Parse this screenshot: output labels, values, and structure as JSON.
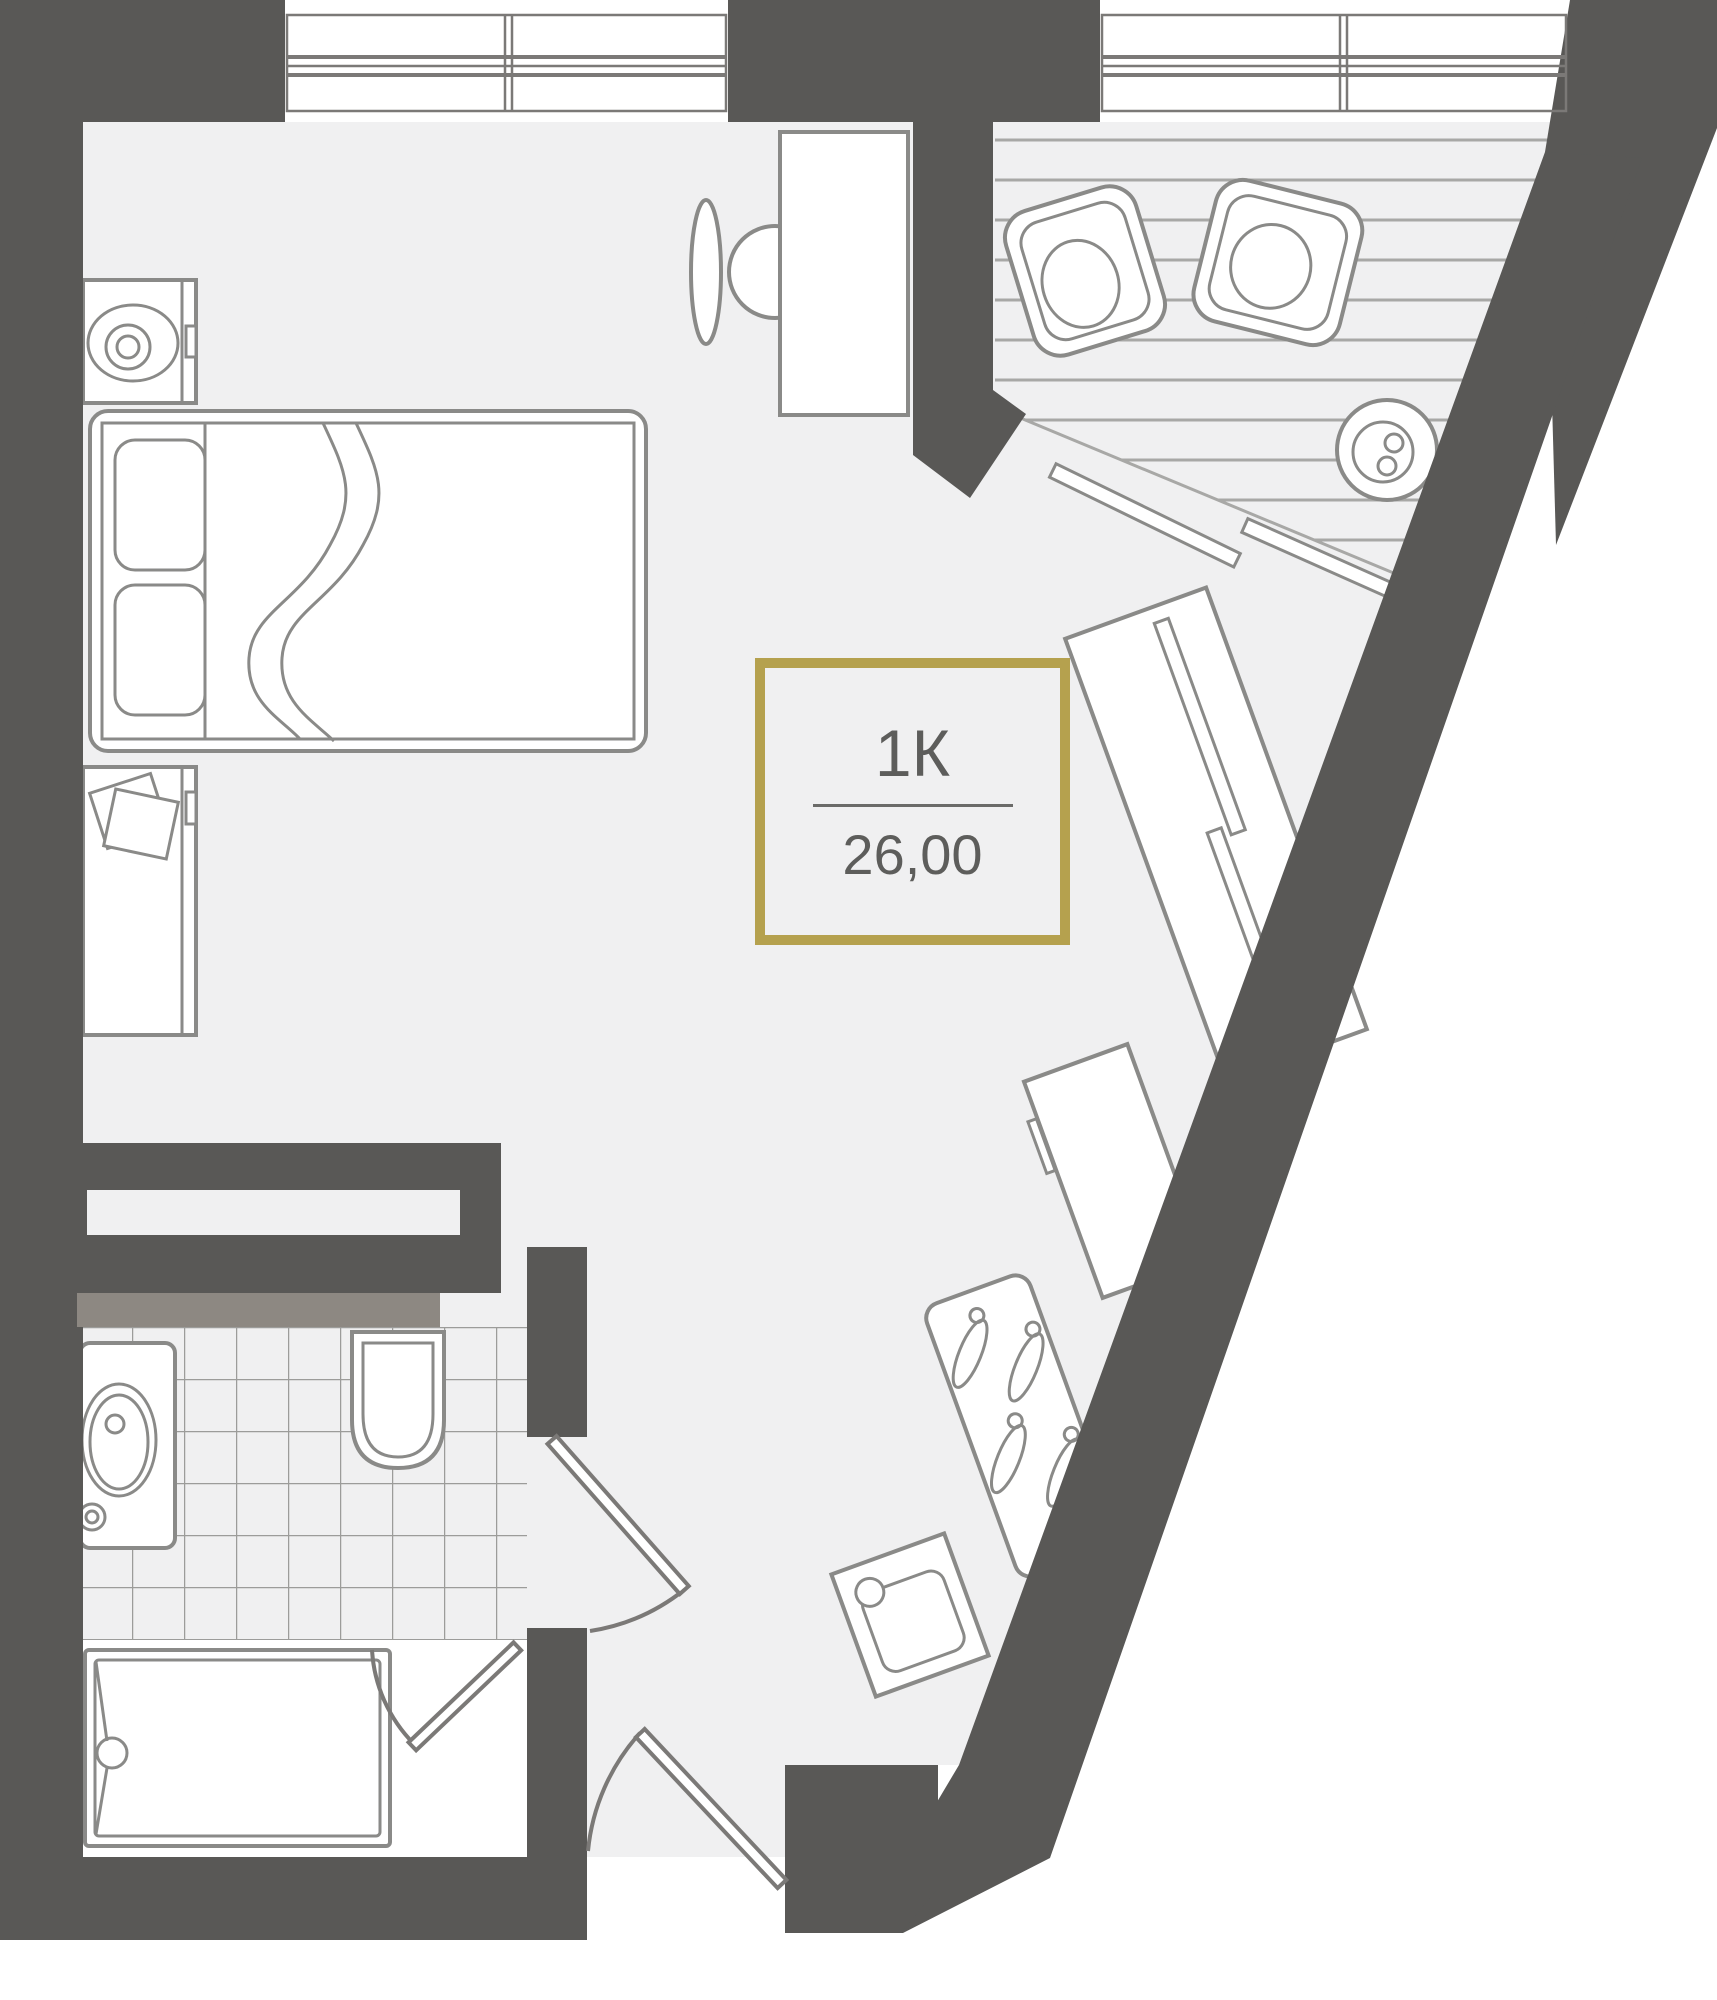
{
  "plan": {
    "unit_label": {
      "type": "1К",
      "area": "26,00"
    }
  },
  "colors": {
    "wall": "#595856",
    "floor": "#f0f0f1",
    "line": "#8a8a88",
    "linedark": "#7b7977",
    "stripe": "#a8a8a6",
    "tile": "#9c9c9a",
    "band": "#8d8882",
    "gold": "#b5a14e",
    "text": "#5d5d5b",
    "white": "#ffffff"
  },
  "icons": {
    "bed": "double-bed-icon",
    "nightstand_top": "nightstand-icon",
    "nightstand_bottom": "nightstand-icon",
    "desk": "desk-icon",
    "desk_chair": "chair-icon",
    "armchair_left": "armchair-icon",
    "armchair_right": "armchair-icon",
    "coffee_table": "round-table-icon",
    "wardrobe": "wardrobe-icon",
    "fridge": "fridge-counter-icon",
    "stove": "gas-stove-icon",
    "sink": "kitchen-sink-icon",
    "vanity": "bathroom-sink-icon",
    "toilet": "toilet-icon",
    "shower": "shower-tray-icon",
    "doors": "door-swing-icon",
    "windows": "window-icon"
  }
}
